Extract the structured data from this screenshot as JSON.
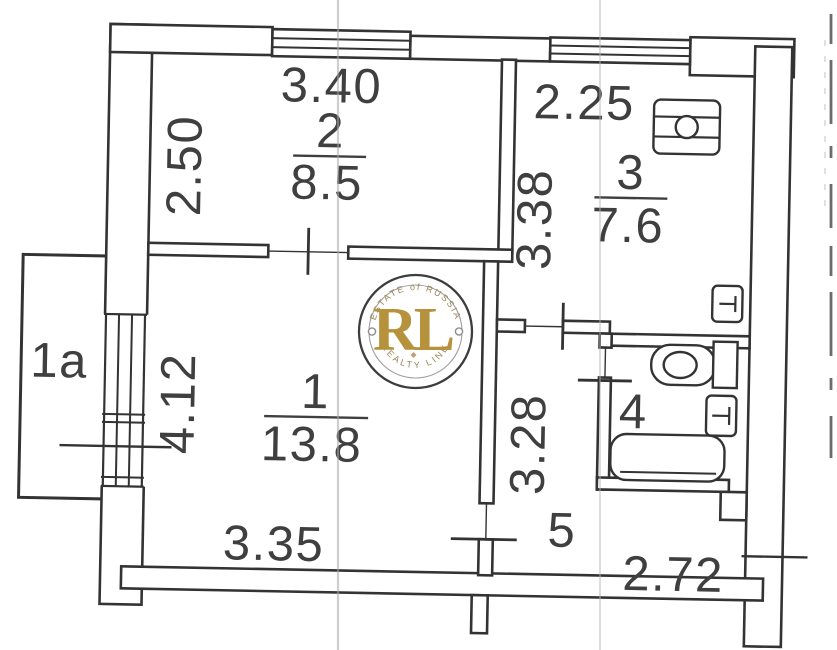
{
  "rooms": {
    "living": {
      "number": "1",
      "area": "13.8",
      "dim_width": "3.35",
      "dim_height": "4.12"
    },
    "bedroom": {
      "number": "2",
      "area": "8.5",
      "dim_width": "3.40",
      "dim_height": "2.50"
    },
    "kitchen": {
      "number": "3",
      "area": "7.6",
      "dim_width": "2.25",
      "dim_height": "3.38"
    },
    "bathroom": {
      "number": "4"
    },
    "hallway": {
      "number": "5",
      "dim_height": "3.28",
      "dim_width_bottom": "2.72"
    },
    "balcony": {
      "number": "1a"
    }
  },
  "watermark": {
    "initials": "RL",
    "arc_top": "ESTATE of RUSSIA",
    "arc_bottom": "REALTY LINE",
    "gold": "#b6923c",
    "ring": "#3d3d3d"
  },
  "icons": {
    "stove": "stove-icon",
    "toilet": "toilet-icon",
    "bathtub": "bathtub-icon",
    "radiator_kitchen": "radiator-icon",
    "radiator_bathroom": "radiator-icon",
    "window_bedroom": "window-icon",
    "window_kitchen": "window-icon",
    "balcony_door_window": "balcony-window-icon"
  },
  "colors": {
    "ink": "#333333",
    "text": "#3f3f3f",
    "scan_fold_line": "#aaaaaa",
    "paper": "#ffffff"
  }
}
